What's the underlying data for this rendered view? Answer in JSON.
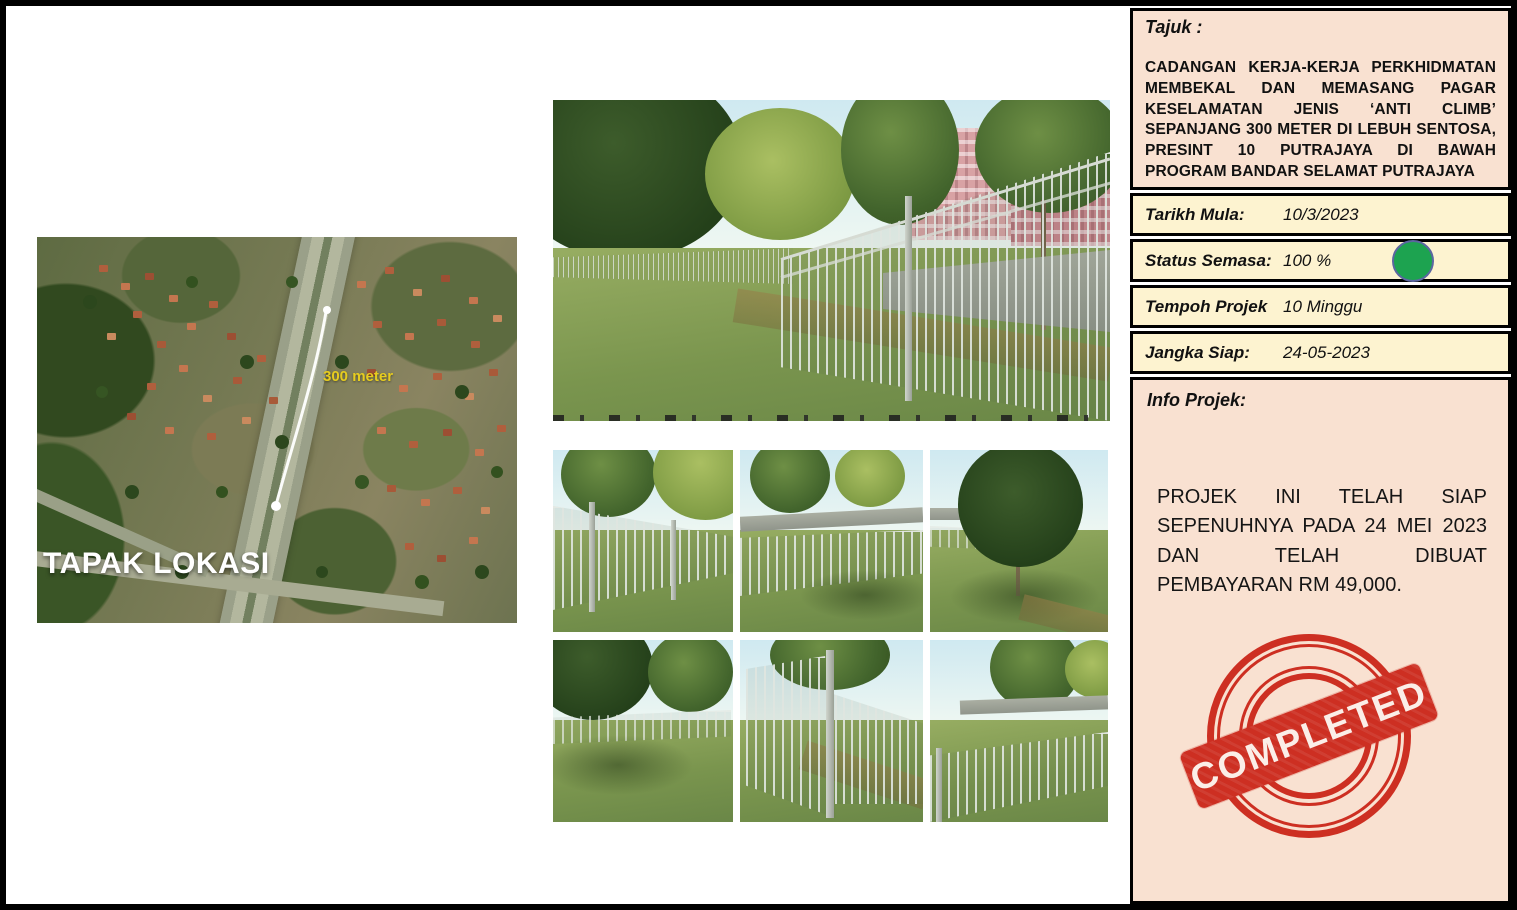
{
  "panel": {
    "tajuk_label": "Tajuk :",
    "tajuk_text": "CADANGAN KERJA-KERJA PERKHIDMATAN MEMBEKAL DAN MEMASANG PAGAR KESELAMATAN JENIS ‘ANTI CLIMB’ SEPANJANG 300 METER DI LEBUH SENTOSA, PRESINT 10 PUTRAJAYA DI BAWAH PROGRAM BANDAR SELAMAT PUTRAJAYA",
    "fields": [
      {
        "label": "Tarikh Mula:",
        "value": "10/3/2023"
      },
      {
        "label": "Status Semasa:",
        "value": "100 %"
      },
      {
        "label": "Tempoh Projek",
        "value": "10 Minggu"
      },
      {
        "label": "Jangka Siap:",
        "value": "24-05-2023"
      }
    ],
    "info_label": "Info Projek:",
    "info_text": "PROJEK INI TELAH SIAP SEPENUHNYA PADA 24 MEI 2023 DAN TELAH DIBUAT PEMBAYARAN RM 49,000.",
    "stamp_text": "COMPLETED"
  },
  "map": {
    "title": "TAPAK LOKASI",
    "distance_label": "300 meter"
  },
  "colors": {
    "status_green": "#1da350",
    "stamp_red": "#cd2f22",
    "panel_peach": "#f9e1d1",
    "panel_yellow": "#fdf3d0",
    "distance_yellow": "#e6cc1f"
  }
}
